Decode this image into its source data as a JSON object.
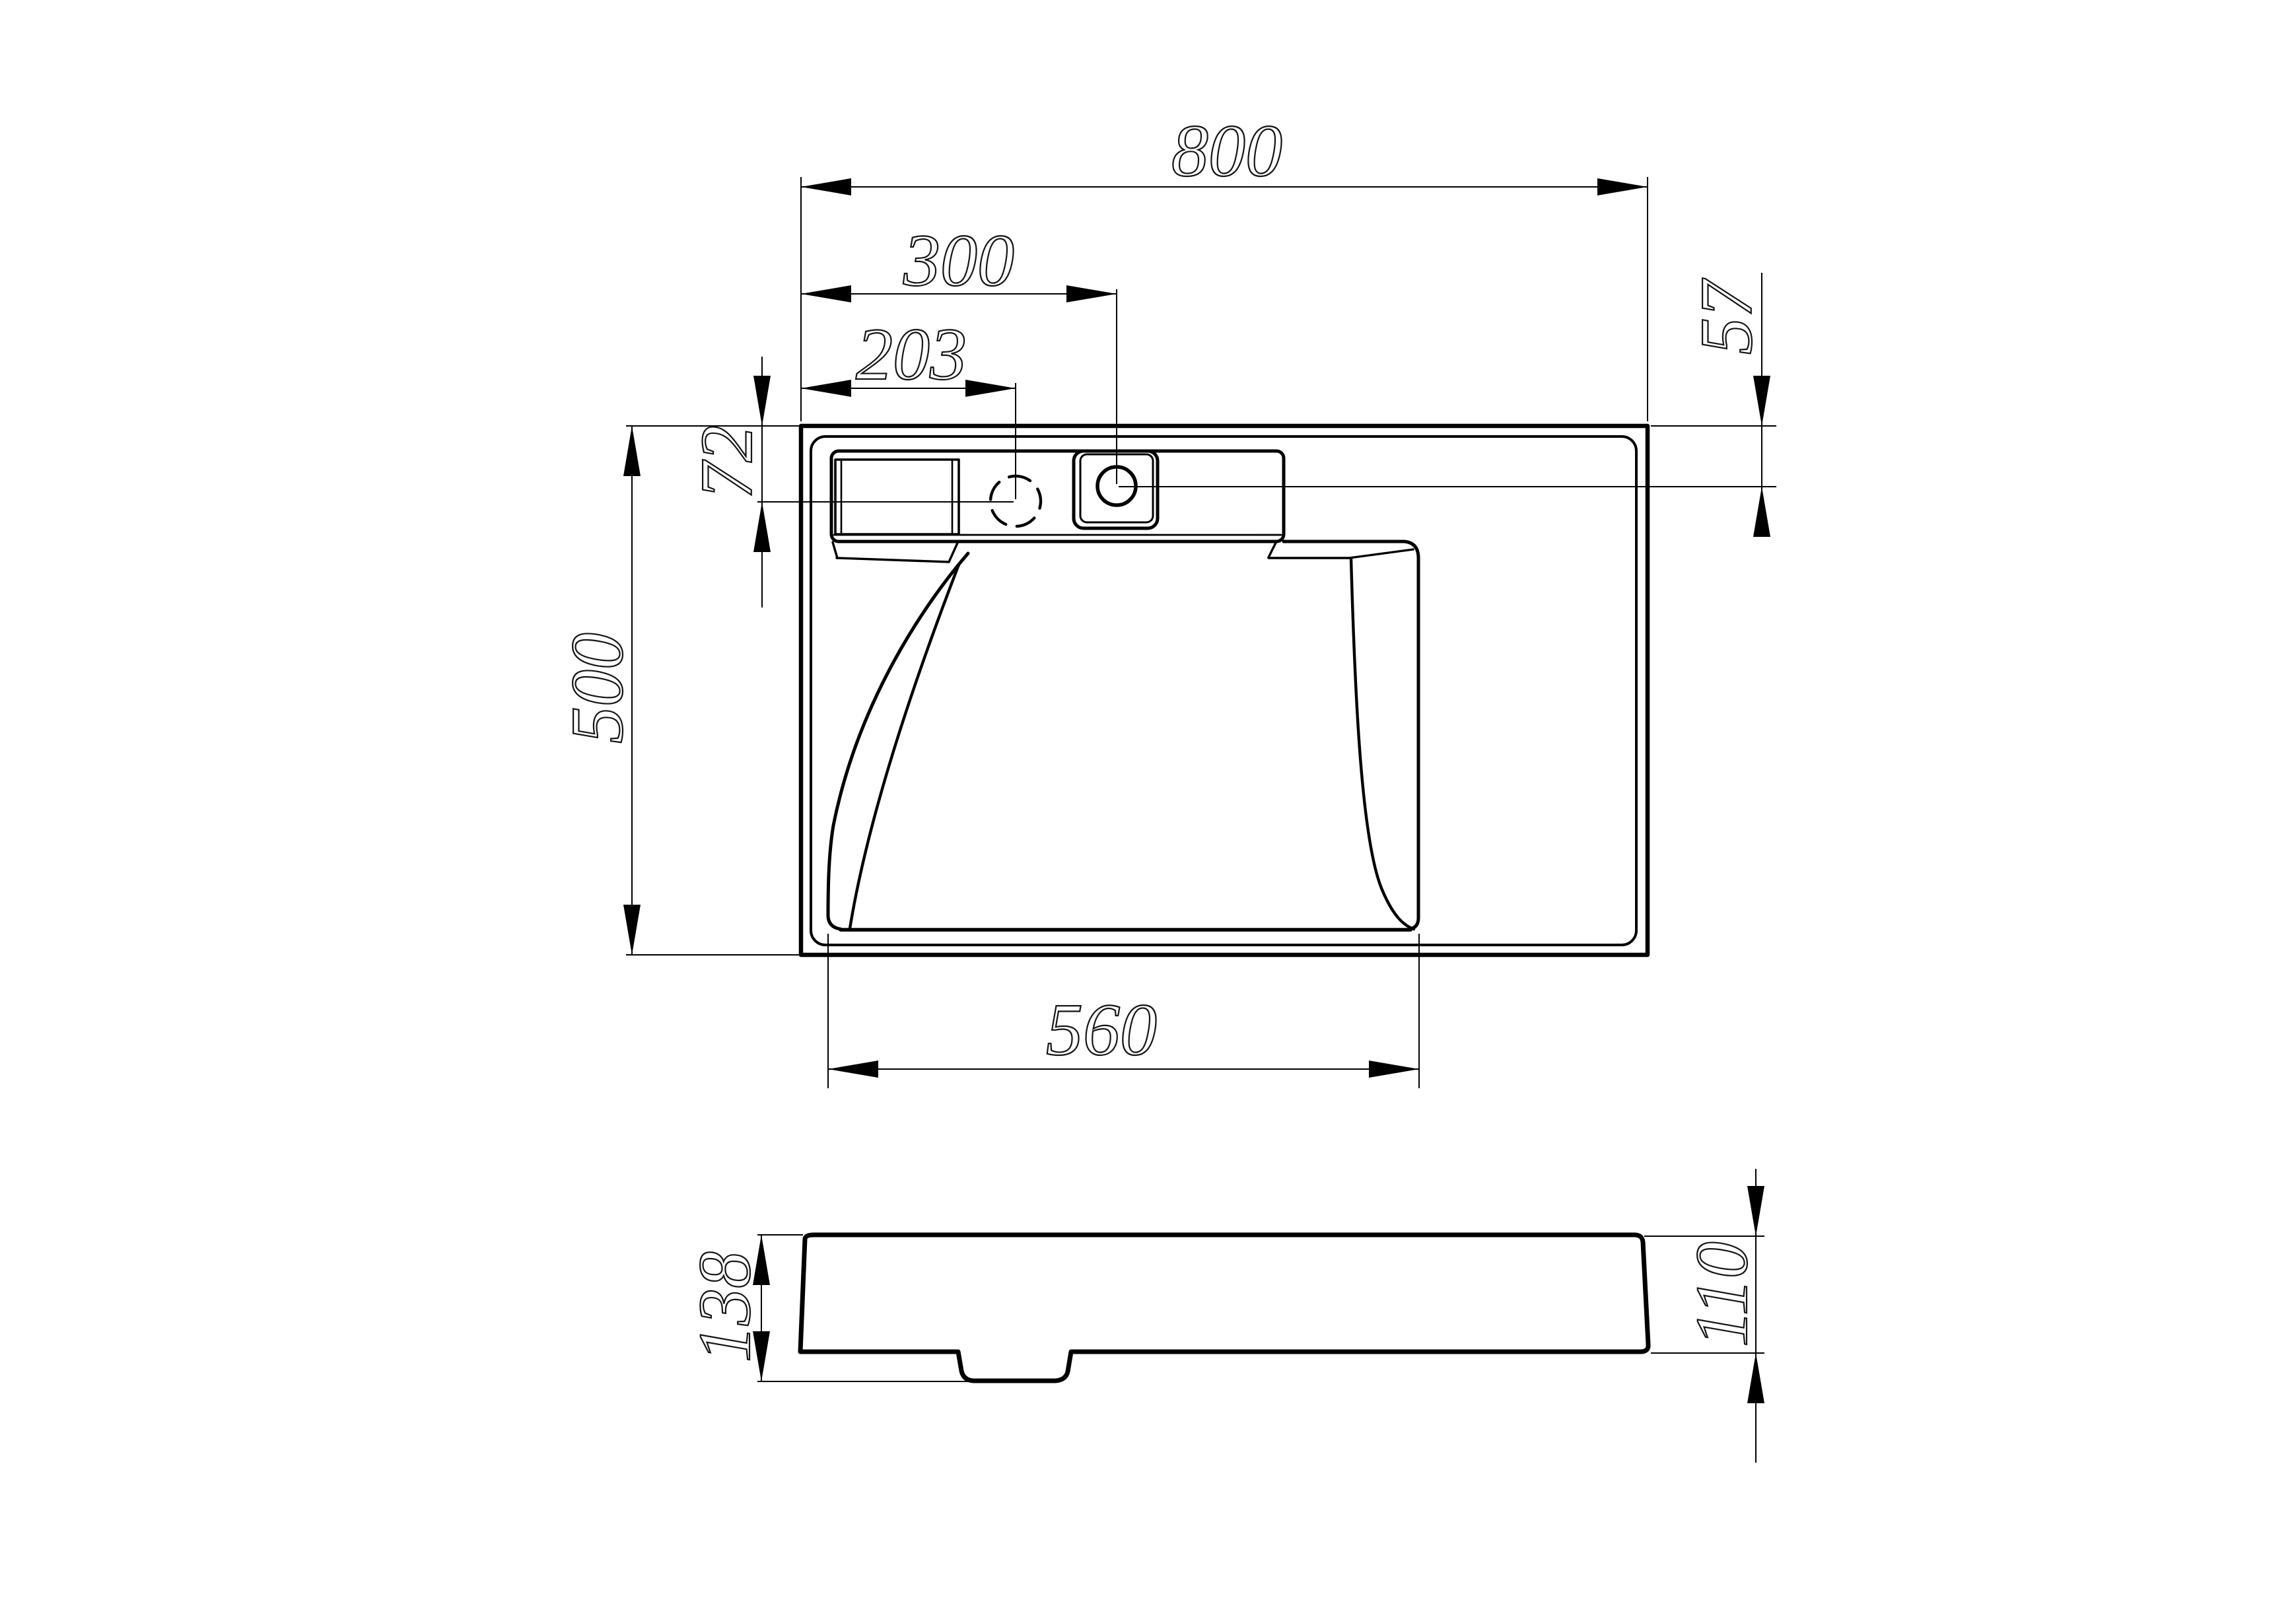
{
  "drawing": {
    "type": "technical-drawing",
    "subject": "wall-hung washbasin, plan view and side elevation",
    "background_color": "#ffffff",
    "line_color": "#000000",
    "views": {
      "top": {
        "label": "top-view"
      },
      "side": {
        "label": "side-view"
      }
    },
    "dimensions": {
      "overall_width": "800",
      "faucet_hole_offset_x": "300",
      "predrill_offset_x": "203",
      "faucet_hole_offset_y": "57",
      "predrill_offset_y": "72",
      "overall_depth": "500",
      "basin_width": "560",
      "overall_height": "138",
      "edge_height": "110"
    }
  }
}
